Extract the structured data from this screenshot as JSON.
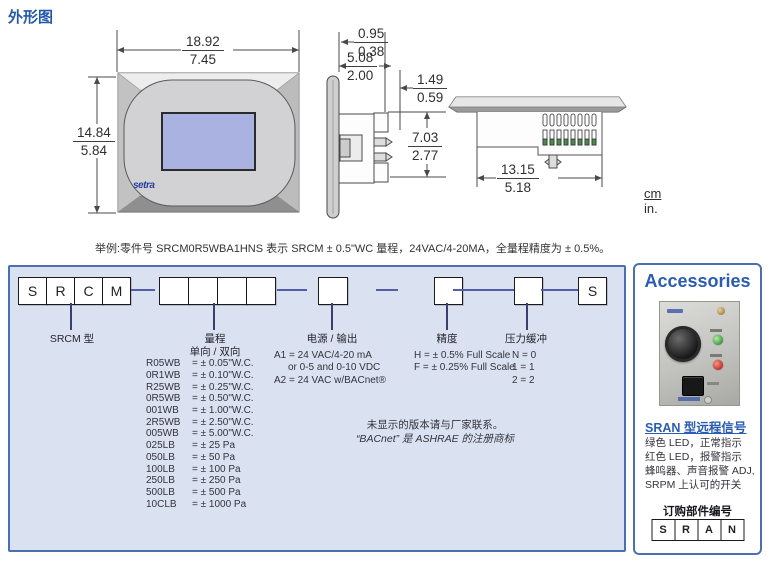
{
  "page": {
    "title": "外形图",
    "example_line": "举例:零件号 SRCM0R5WBA1HNS 表示 SRCM ± 0.5\"WC 量程，24VAC/4-20MA，全量程精度为 ± 0.5%。",
    "units": {
      "cm": "cm",
      "inch": "in."
    }
  },
  "drawings": {
    "front": {
      "width_cm": "18.92",
      "width_in": "7.45",
      "height_cm": "14.84",
      "height_in": "5.84",
      "logo": "setra"
    },
    "side": {
      "bezel_cm": "0.95",
      "bezel_in": "0.38",
      "depth_cm": "5.08",
      "depth_in": "2.00",
      "tab_cm": "1.49",
      "tab_in": "0.59",
      "body_cm": "7.03",
      "body_in": "2.77"
    },
    "bottom": {
      "width_cm": "13.15",
      "width_in": "5.18"
    }
  },
  "ordering": {
    "model_boxes": [
      "S",
      "R",
      "C",
      "M"
    ],
    "model_label": "SRCM 型",
    "suffix_box": "S",
    "range": {
      "label": "量程",
      "sublabel": "单向 / 双向",
      "items": [
        {
          "code": "R05WB",
          "value": "= ± 0.05\"W.C."
        },
        {
          "code": "0R1WB",
          "value": "= ± 0.10\"W.C."
        },
        {
          "code": "R25WB",
          "value": "= ± 0.25\"W.C."
        },
        {
          "code": "0R5WB",
          "value": "= ± 0.50\"W.C."
        },
        {
          "code": "001WB",
          "value": "= ± 1.00\"W.C."
        },
        {
          "code": "2R5WB",
          "value": "= ± 2.50\"W.C."
        },
        {
          "code": "005WB",
          "value": "= ± 5.00\"W.C."
        },
        {
          "code": "025LB",
          "value": "= ± 25 Pa"
        },
        {
          "code": "050LB",
          "value": "= ± 50 Pa"
        },
        {
          "code": "100LB",
          "value": "= ± 100 Pa"
        },
        {
          "code": "250LB",
          "value": "= ± 250 Pa"
        },
        {
          "code": "500LB",
          "value": "= ± 500 Pa"
        },
        {
          "code": "10CLB",
          "value": "= ± 1000 Pa"
        }
      ]
    },
    "power": {
      "label": "电源 / 输出",
      "lines": [
        "A1 = 24 VAC/4-20 mA",
        "or 0-5 and 0-10 VDC",
        "A2 = 24 VAC w/BACnet®"
      ]
    },
    "accuracy": {
      "label": "精度",
      "lines": [
        "H = ± 0.5% Full Scale",
        "F = ± 0.25% Full Scale"
      ]
    },
    "damping": {
      "label": "压力缓冲",
      "lines": [
        "N = 0",
        "1 = 1",
        "2 = 2"
      ]
    },
    "notes": [
      "未显示的版本请与厂家联系。",
      "“BACnet” 是 ASHRAE 的注册商标"
    ]
  },
  "accessories": {
    "title": "Accessories",
    "heading": "SRAN 型远程信号",
    "features": [
      "绿色 LED，正常指示",
      "红色 LED，报警指示",
      "蜂鸣器、声音报警 ADJ,",
      "SRPM 上认可的开关"
    ],
    "order_label": "订购部件编号",
    "part_boxes": [
      "S",
      "R",
      "A",
      "N"
    ]
  },
  "colors": {
    "title_blue": "#2358aa",
    "panel_border_blue": "#4a70b2",
    "panel_bg": "#dae1f0",
    "accessories_blue": "#2a5cb4",
    "screen_lavender": "#a9b2e0",
    "connector_blue": "#545ea8",
    "led_green": "#1e7020",
    "led_red": "#a01008"
  }
}
